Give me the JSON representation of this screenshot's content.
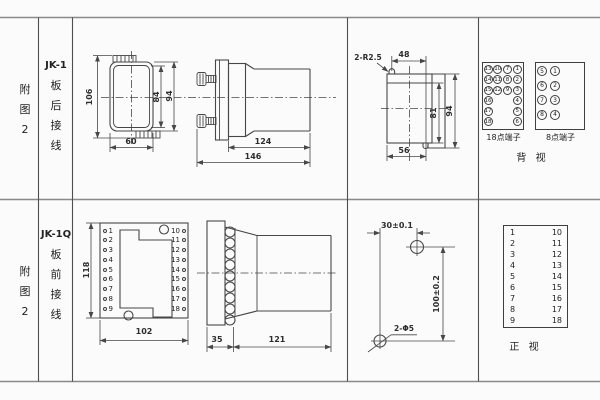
{
  "figure": {
    "rows": [
      {
        "fig_no": [
          "附",
          "图",
          "2"
        ],
        "model": {
          "code": "JK-1",
          "chars": [
            "板",
            "后",
            "接",
            "线"
          ]
        },
        "front_view": {
          "dim_total_height": "106",
          "dim_inner_height": "84",
          "dim_outer_height": "94",
          "dim_width": "60"
        },
        "side_view": {
          "dim_body": "124",
          "dim_total": "146"
        },
        "cutout_view": {
          "note_radius": "2-R2.5",
          "dim_top": "48",
          "dim_inner_h": "81",
          "dim_outer_h": "94",
          "dim_bottom": "56"
        },
        "panel": {
          "t18": {
            "caption": "18点端子",
            "col1": [
              "13",
              "14",
              "15",
              "16",
              "17",
              "18"
            ],
            "col2": [
              "10",
              "11",
              "12"
            ],
            "col3": [
              "7",
              "8",
              "9"
            ],
            "col4": [
              "1",
              "2",
              "3",
              "4",
              "5",
              "6"
            ]
          },
          "t8": {
            "caption": "8点端子",
            "col1": [
              "5",
              "6",
              "7",
              "8"
            ],
            "col2": [
              "1",
              "2",
              "3",
              "4"
            ]
          },
          "view_label": "背 视"
        }
      },
      {
        "fig_no": [
          "附",
          "图",
          "2"
        ],
        "model": {
          "code": "JK-1Q",
          "chars": [
            "板",
            "前",
            "接",
            "线"
          ]
        },
        "front_view": {
          "left": [
            "1",
            "2",
            "3",
            "4",
            "5",
            "6",
            "7",
            "8",
            "9"
          ],
          "right": [
            "10",
            "11",
            "12",
            "13",
            "14",
            "15",
            "16",
            "17",
            "18"
          ],
          "dim_height": "118",
          "dim_width": "102"
        },
        "side_view": {
          "dim_plate": "35",
          "dim_body": "121"
        },
        "drill_view": {
          "dim_h": "30±0.1",
          "dim_v": "100±0.2",
          "note_holes": "2-Φ5"
        },
        "panel": {
          "table_left": [
            "1",
            "2",
            "3",
            "4",
            "5",
            "6",
            "7",
            "8",
            "9"
          ],
          "table_right": [
            "10",
            "11",
            "12",
            "13",
            "14",
            "15",
            "16",
            "17",
            "18"
          ],
          "view_label": "正 视"
        }
      }
    ]
  }
}
